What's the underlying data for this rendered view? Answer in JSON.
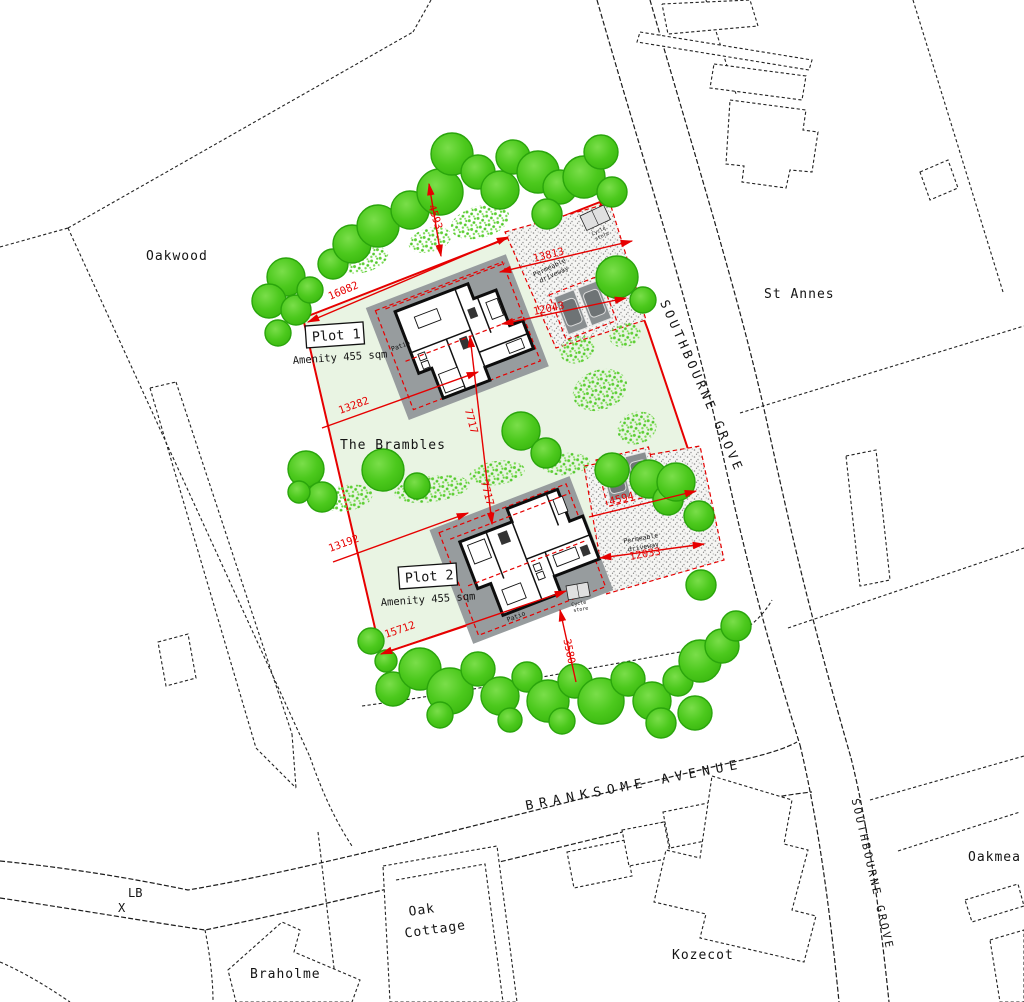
{
  "plan": {
    "site_name": "The Brambles",
    "properties": {
      "oakwood": "Oakwood",
      "st_annes": "St Annes",
      "oakmea": "Oakmea",
      "oak_cottage_line1": "Oak",
      "oak_cottage_line2": "Cottage",
      "kozecot": "Kozecot",
      "braholme": "Braholme"
    },
    "roads": {
      "southbourne_grove_upper": "SOUTHBOURNE GROVE",
      "southbourne_grove_lower": "SOUTHBOURNE GROVE",
      "branksome_avenue": "BRANKSOME AVENUE"
    },
    "map_marks": {
      "lb": "LB",
      "x": "X"
    },
    "plot1": {
      "title": "Plot 1",
      "amenity": "Amenity 455 sqm",
      "patio": "Patio",
      "driveway_line1": "Permeable",
      "driveway_line2": "driveway",
      "store_line1": "Cycle",
      "store_line2": "store"
    },
    "plot2": {
      "title": "Plot 2",
      "amenity": "Amenity 455 sqm",
      "patio": "Patio",
      "driveway_line1": "Permeable",
      "driveway_line2": "driveway",
      "store_line1": "Cycle",
      "store_line2": "store"
    },
    "dimensions": {
      "d16082": "16082",
      "d13282": "13282",
      "d7717a": "7717",
      "d7717b": "7717",
      "d4593": "4593",
      "d13813": "13813",
      "d12043": "12043",
      "d13192": "13192",
      "d15712": "15712",
      "d4594": "4594",
      "d12033": "12033",
      "d3580": "3580"
    }
  },
  "colors": {
    "site_green": "#e9f4e3",
    "boundary_red": "#e60000",
    "tree_green": "#46c616",
    "patio_gray": "#979c9e",
    "line_black": "#1c1c1c"
  }
}
